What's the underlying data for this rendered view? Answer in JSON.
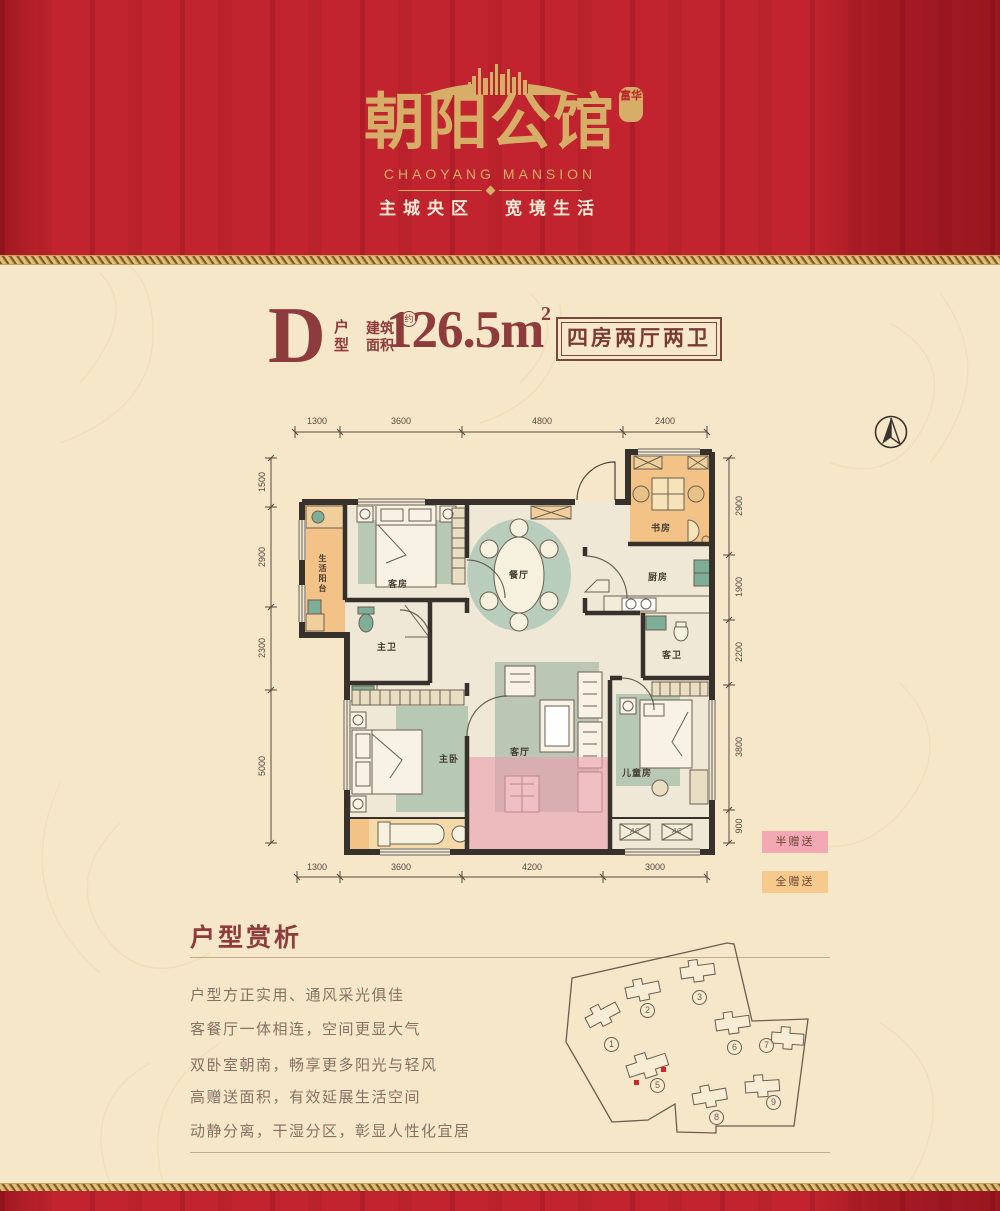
{
  "header": {
    "brand": "朝阳公馆",
    "seal": "富华",
    "brand_en": "CHAOYANG MANSION",
    "slogan_left": "主城央区",
    "slogan_right": "宽境生活"
  },
  "title": {
    "letter": "D",
    "unit_label": "户型",
    "area_label": "建筑面积",
    "approx": "约",
    "area_value": "126.5m",
    "area_sup": "2",
    "badge": "四房两厅两卫"
  },
  "floorplan": {
    "dims_top": [
      "1300",
      "3600",
      "4800",
      "2400"
    ],
    "dims_bottom": [
      "1300",
      "3600",
      "4200",
      "3000"
    ],
    "dims_left": [
      "1500",
      "2900",
      "2300",
      "5000"
    ],
    "dims_right": [
      "2900",
      "1900",
      "2200",
      "3800",
      "900"
    ],
    "rooms": {
      "balcony": "生活阳台",
      "guest_room": "客房",
      "dining": "餐厅",
      "study": "书房",
      "kitchen": "厨房",
      "master_bath": "主卫",
      "guest_bath": "客卫",
      "master_bed": "主卧",
      "living": "客厅",
      "kids": "儿童房"
    },
    "ac": [
      "AC",
      "AC"
    ],
    "legend": [
      {
        "label": "半赠送",
        "color": "#f2a9b4"
      },
      {
        "label": "全赠送",
        "color": "#f6c98c"
      }
    ]
  },
  "analysis": {
    "title": "户型赏析",
    "lines": [
      "户型方正实用、通风采光俱佳",
      "客餐厅一体相连，空间更显大气",
      "双卧室朝南，畅享更多阳光与轻风",
      "高赠送面积，有效延展生活空间",
      "动静分离，干湿分区，彰显人性化宜居"
    ]
  },
  "siteplan": {
    "buildings": [
      {
        "no": "1"
      },
      {
        "no": "2"
      },
      {
        "no": "3"
      },
      {
        "no": "5"
      },
      {
        "no": "6"
      },
      {
        "no": "7"
      },
      {
        "no": "8"
      },
      {
        "no": "9"
      }
    ],
    "highlight_building": "5"
  },
  "colors": {
    "red": "#c1242e",
    "gold": "#d6ae67",
    "cream": "#f6e7c9",
    "maroon": "#8e3b3d",
    "wall": "#37312c",
    "gift_half_pink": "#f2a9b4",
    "gift_full_orange": "#f6c98c",
    "rug_green": "#b7c9b4"
  }
}
